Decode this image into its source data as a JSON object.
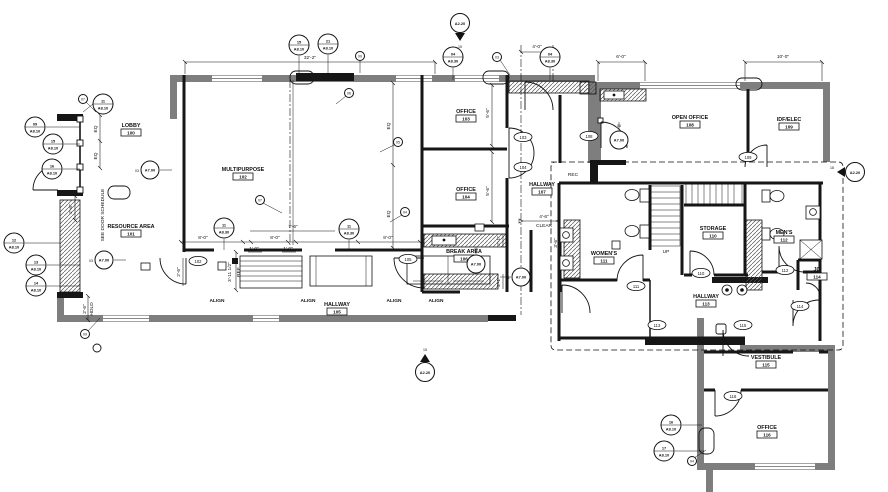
{
  "colors": {
    "wall_gray": "#7e7e7e",
    "wall_black": "#161616",
    "paper": "#ffffff"
  },
  "rooms": [
    {
      "name": "LOBBY",
      "number": "100"
    },
    {
      "name": "RESOURCE AREA",
      "number": "101"
    },
    {
      "name": "MULTIPURPOSE",
      "number": "102"
    },
    {
      "name": "OFFICE",
      "number": "103"
    },
    {
      "name": "OFFICE",
      "number": "104"
    },
    {
      "name": "HALLWAY",
      "number": "105"
    },
    {
      "name": "BREAK AREA",
      "number": "106"
    },
    {
      "name": "HALLWAY",
      "number": "107"
    },
    {
      "name": "OPEN OFFICE",
      "number": "108"
    },
    {
      "name": "IDF/ELEC",
      "number": "109"
    },
    {
      "name": "STORAGE",
      "number": "110"
    },
    {
      "name": "WOMEN'S",
      "number": "111"
    },
    {
      "name": "MEN'S",
      "number": "112"
    },
    {
      "name": "HALLWAY",
      "number": "113"
    },
    {
      "name": "JC",
      "number": "114"
    },
    {
      "name": "VESTIBULE",
      "number": "115"
    },
    {
      "name": "OFFICE",
      "number": "116"
    }
  ],
  "ann": [
    {
      "t": "32'-2\""
    },
    {
      "t": "4'-0\""
    },
    {
      "t": "6'-0\""
    },
    {
      "t": "10'-0\""
    },
    {
      "t": "EQ"
    },
    {
      "t": "EQ"
    },
    {
      "t": "EQ"
    },
    {
      "t": "EQ"
    },
    {
      "t": "2'-6\""
    },
    {
      "t": "2'-6\""
    },
    {
      "t": "HOLD"
    },
    {
      "t": "8'-0\""
    },
    {
      "t": "8'-0\""
    },
    {
      "t": "7'-6\""
    },
    {
      "t": "1'-0\""
    },
    {
      "t": "1'-0\""
    },
    {
      "t": "8'-0\""
    },
    {
      "t": "3'-11 1/2\""
    },
    {
      "t": "REF"
    },
    {
      "t": "5'-6\""
    },
    {
      "t": "5'-6\""
    },
    {
      "t": "2'-1\""
    },
    {
      "t": "2'-1\""
    },
    {
      "t": "3'-6\""
    },
    {
      "t": "4'-6\""
    },
    {
      "t": "CLEAR"
    },
    {
      "t": "2'-6\""
    },
    {
      "t": "SEE DOOR SCHEDULE"
    },
    {
      "t": "ALIGN"
    },
    {
      "t": "ALIGN"
    },
    {
      "t": "ALIGN"
    },
    {
      "t": "ALIGN"
    },
    {
      "t": "UP"
    },
    {
      "t": "REC"
    }
  ],
  "callouts": [
    {
      "n": "11",
      "s": "A8.10"
    },
    {
      "n": "09",
      "s": "A8.10"
    },
    {
      "n": "15",
      "s": "A8.10"
    },
    {
      "n": "16",
      "s": "A8.10"
    },
    {
      "n": "12",
      "s": "A8.10"
    },
    {
      "n": "13",
      "s": "A8.10"
    },
    {
      "n": "14",
      "s": "A8.10"
    },
    {
      "n": "15",
      "s": "A8.10"
    },
    {
      "n": "21",
      "s": "A8.10"
    },
    {
      "n": "04",
      "s": "A8.30"
    },
    {
      "n": "04",
      "s": "A8.30"
    },
    {
      "n": "11",
      "s": "A8.30"
    },
    {
      "n": "11",
      "s": "A8.30"
    },
    {
      "n": "16",
      "s": "A8.10"
    },
    {
      "n": "17",
      "s": "A8.10"
    }
  ],
  "elev": [
    {
      "n": "03",
      "s": "A7.00"
    },
    {
      "n": "03",
      "s": "A7.00"
    },
    {
      "n": "12",
      "s": "A7.00"
    },
    {
      "n": "11",
      "s": "A7.00"
    },
    {
      "n": "06",
      "s": "A7.00"
    }
  ],
  "sect": [
    {
      "n": "15",
      "s": "A2.20"
    },
    {
      "n": "15",
      "s": "A2.20"
    },
    {
      "n": "18",
      "s": "A2.20"
    }
  ],
  "tags": [
    {
      "n": "102"
    },
    {
      "n": "103"
    },
    {
      "n": "104"
    },
    {
      "n": "105"
    },
    {
      "n": "108"
    },
    {
      "n": "109"
    },
    {
      "n": "110"
    },
    {
      "n": "111"
    },
    {
      "n": "112"
    },
    {
      "n": "114"
    },
    {
      "n": "113"
    },
    {
      "n": "115"
    },
    {
      "n": "116"
    }
  ],
  "keys": [
    {
      "n": "07"
    },
    {
      "n": "07"
    },
    {
      "n": "06"
    },
    {
      "n": "05"
    },
    {
      "n": "09"
    },
    {
      "n": "03"
    },
    {
      "n": "09"
    },
    {
      "n": "04"
    },
    {
      "n": "04"
    }
  ]
}
